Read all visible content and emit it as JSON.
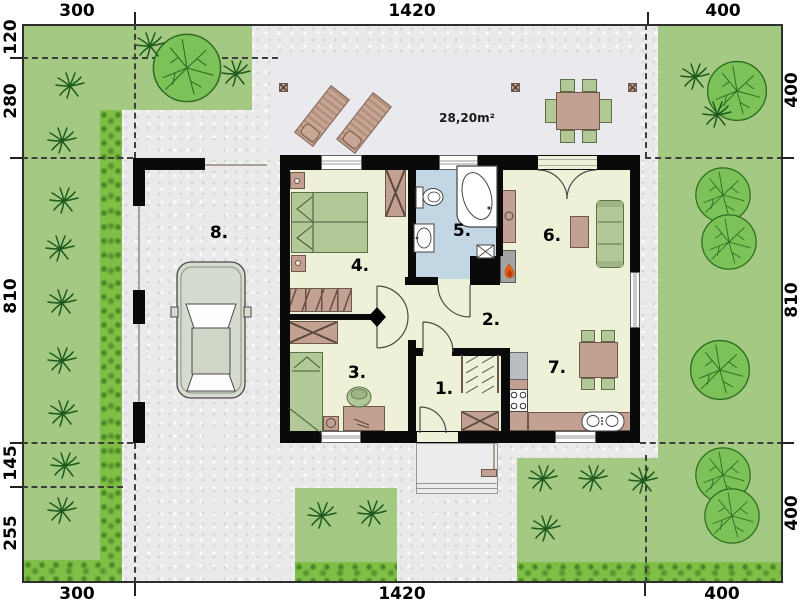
{
  "scale": {
    "top": [
      "300",
      "1420",
      "400"
    ],
    "bottom": [
      "300",
      "1420",
      "400"
    ],
    "left": [
      "120",
      "280",
      "810",
      "145",
      "255"
    ],
    "right": [
      "400",
      "810",
      "400"
    ]
  },
  "rooms": [
    "1.",
    "2.",
    "3.",
    "4.",
    "5.",
    "6.",
    "7.",
    "8."
  ],
  "terrace": {
    "area_label": "28,20m²"
  },
  "colors": {
    "garden_green": "#a4c983",
    "hedge_green": "#7fbf45",
    "paving_gray": "#eaeaea",
    "terrace_gray": "#e9e9ee",
    "floor_cream": "#eef1d8",
    "bathroom_blue": "#c3d6e4",
    "wall_black": "#0a0a0a",
    "wood_brown": "#c2a192",
    "upholstery_green": "#b3c897",
    "flame_orange": "#e8650f",
    "car_body": "#d6dbcf"
  },
  "icons": {
    "tree": "round-canopy-top-view",
    "palm": "leaf-burst-plant",
    "flame": "fireplace-flame",
    "car": "car-top-view",
    "door": "quarter-arc-swing"
  }
}
